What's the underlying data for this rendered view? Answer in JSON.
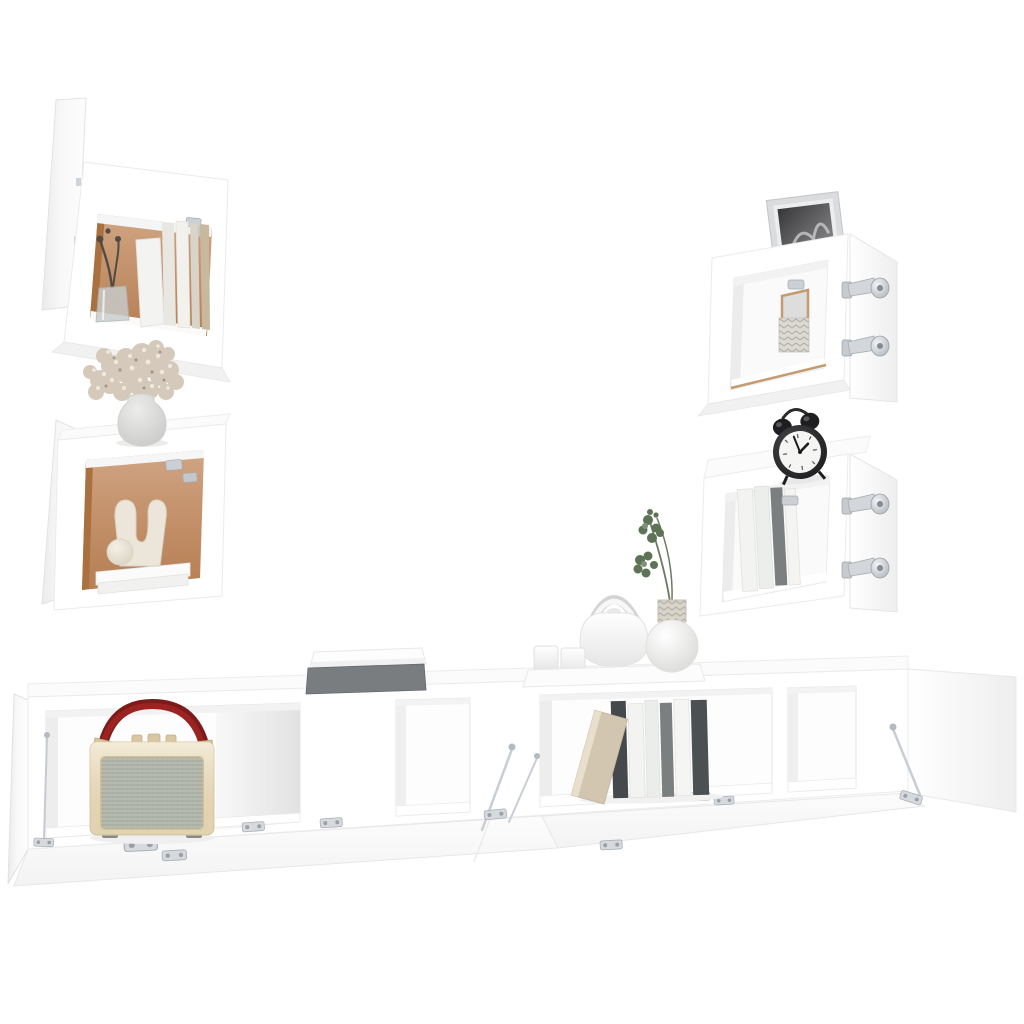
{
  "scene": {
    "type": "furniture-product-photo",
    "subject": "6-piece white wall-mounted TV cabinet set with open doors and decor props",
    "background": "#ffffff"
  },
  "colors": {
    "background": "#ffffff",
    "panel_white": "#ffffff",
    "panel_soft": "#f7f7f7",
    "panel_shadow": "#eeeeee",
    "edge_gray": "#e6e6e6",
    "back_panel": "#c48c61",
    "wood_edge": "#c49a6f",
    "metal": "#c6cbd0",
    "metal_deep": "#9aa0a6",
    "radio_body": "#efe2c3",
    "radio_trim": "#d8c7a0",
    "radio_grille": "#b6bbb0",
    "radio_handle": "#9b2422",
    "clock_black": "#1e1e20",
    "clock_face": "#f5f5f3",
    "frame_silver": "#dbdcdd",
    "photo_dark": "#47474a",
    "flower": "#d5c9bb",
    "flower_light": "#efe9df",
    "vase_gray": "#d6d6d4",
    "sculpture": "#ebe6d9",
    "book_dark": "#45494b",
    "book_gray": "#7b7f80",
    "book_white": "#f3f3f1",
    "book_beige": "#d2c6b0",
    "leaf_green": "#5d7355",
    "stem_green": "#6b7a64",
    "branch_dark": "#4f4c45",
    "box_gray": "#797d80",
    "glass": "#c7cccc",
    "silver_decor": "#dcdad3"
  },
  "pieces": {
    "cube_cabinet_upper_left": "wall cube cabinet, door open left, books and glass vase inside",
    "cube_cabinet_lower_left": "wall cube cabinet, door open left, sculpture on books inside",
    "wall_cabinet_upper_right": "horizontal wall cabinet, door open right, photo frame on top",
    "wall_cabinet_lower_right": "horizontal wall cabinet, door open right, alarm clock on top",
    "tv_bench": "two low tv cabinets in a row with flap doors folded open"
  },
  "props": {
    "glass_vase_branch": "glass vase with dried dark branch",
    "flower_bouquet": "dried beige flower bouquet in round gray vase",
    "sculpture": "white u-shaped sculpture with sphere on white books",
    "photo_frame": "silver frame with black and white photo",
    "decor_mirror_vase": "small wood-framed mirror and woven silver vase",
    "alarm_clock": "black twin-bell alarm clock",
    "radio": "retro cream radio with gray grille and red handle",
    "storage_box": "dark gray box with white lid",
    "tea_set": "white teapot, two cups on white tray",
    "eucalyptus_vase": "round white vase with eucalyptus sprigs",
    "book_row": "row of standing books with one leaning beige book",
    "hardware": "silver concealed hinges and lid stay rods"
  }
}
